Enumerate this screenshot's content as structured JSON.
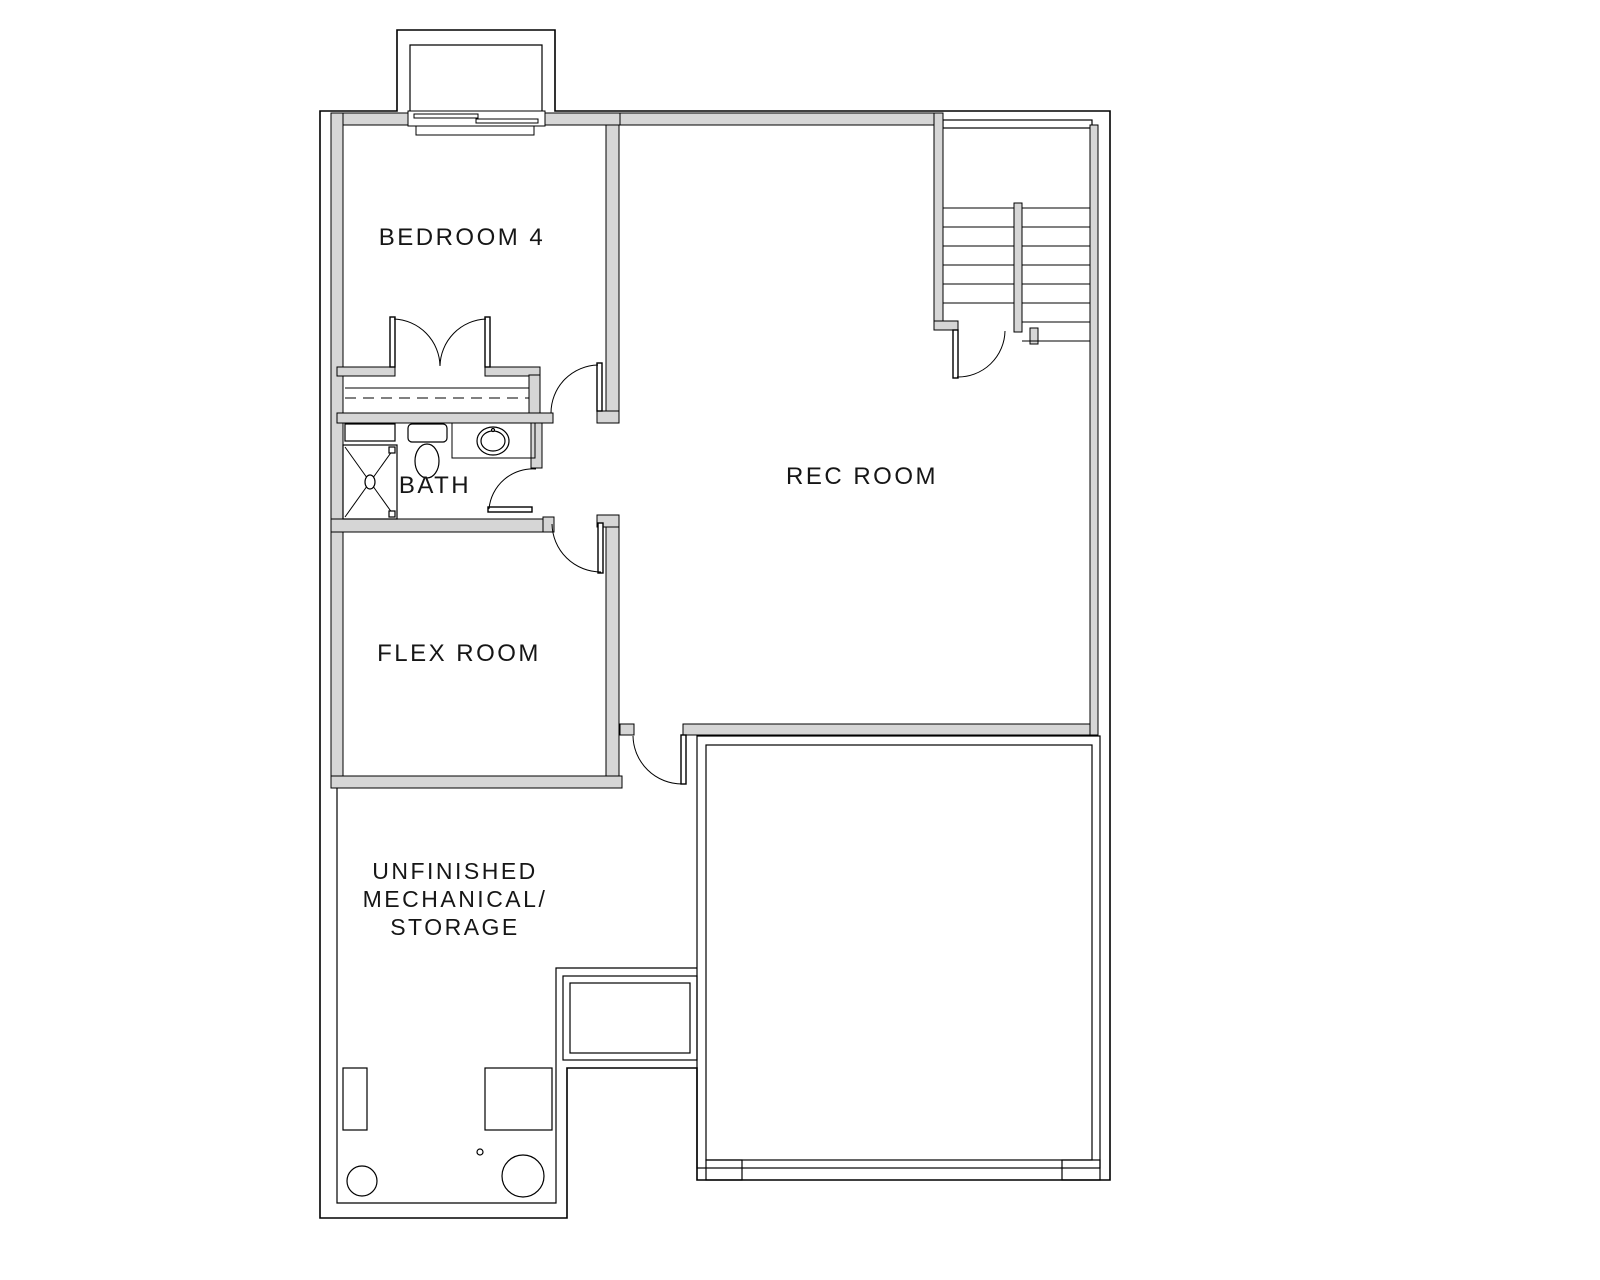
{
  "document": {
    "type": "architectural-floor-plan",
    "level": "basement",
    "background_color": "#ffffff",
    "line_color": "#000000",
    "wall_fill_color": "#d6d6d6",
    "label_color": "#161616"
  },
  "rooms": {
    "bedroom4": {
      "label": "BEDROOM 4"
    },
    "rec_room": {
      "label": "REC ROOM"
    },
    "bath": {
      "label": "BATH"
    },
    "flex_room": {
      "label": "FLEX ROOM"
    },
    "mechanical": {
      "label_line1": "UNFINISHED",
      "label_line2": "MECHANICAL/",
      "label_line3": "STORAGE"
    }
  }
}
